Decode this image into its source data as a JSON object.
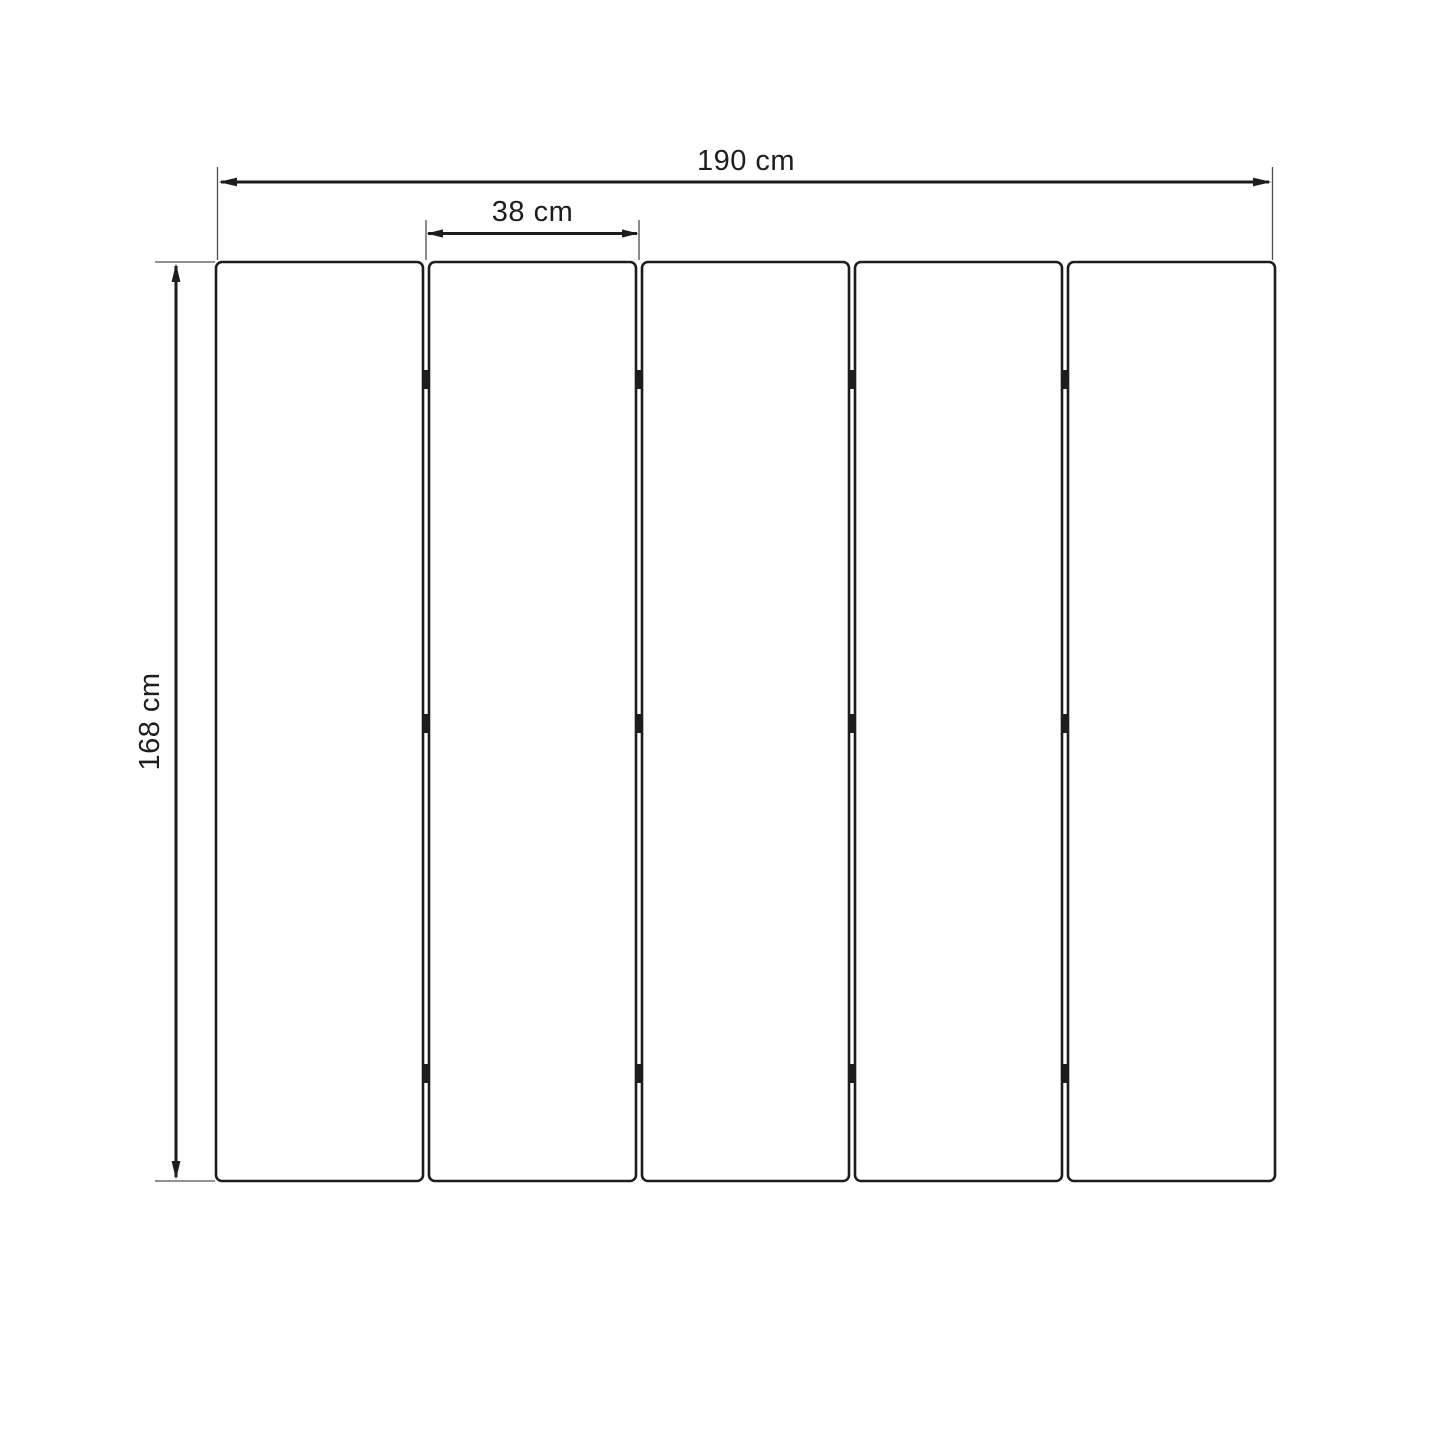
{
  "diagram": {
    "type": "technical-dimension-drawing",
    "subject": "five-panel folding screen front view with hinges",
    "labels": {
      "total_width": "190 cm",
      "panel_width": "38 cm",
      "height": "168 cm"
    },
    "values": {
      "total_width_cm": 190,
      "panel_width_cm": 38,
      "height_cm": 168
    },
    "panel_count": 5,
    "hinge_columns": 4,
    "hinge_rows": 3,
    "colors": {
      "line": "#1d1d1d",
      "extension_line": "#4f4f4f",
      "text": "#1d1d1d",
      "background": "#ffffff"
    }
  }
}
